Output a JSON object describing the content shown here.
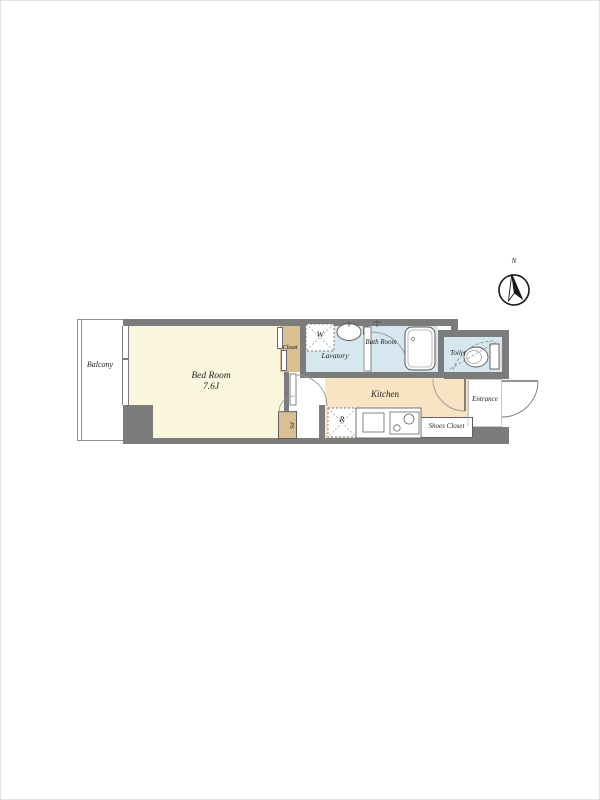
{
  "compass": {
    "north_label": "N"
  },
  "rooms": {
    "balcony": {
      "label": "Balcony"
    },
    "bedroom": {
      "label": "Bed Room",
      "size": "7.6J"
    },
    "closet": {
      "label": "Closet"
    },
    "lavatory": {
      "label": "Lavatory",
      "washer_label": "W"
    },
    "bath_room": {
      "label": "Bath Room"
    },
    "toilet": {
      "label": "Toilet"
    },
    "kitchen": {
      "label": "Kitchen",
      "refrigerator_label": "R"
    },
    "entrance": {
      "label": "Entrance"
    },
    "shoes_closet": {
      "label": "Shoes Closet"
    },
    "pipe_space": {
      "label": "PS"
    }
  },
  "colors": {
    "wall": "#7c7c7c",
    "bedroom": "#faf6dd",
    "closet": "#d8c093",
    "wet": "#d6e7f0",
    "kitchen": "#f8e3c2"
  }
}
